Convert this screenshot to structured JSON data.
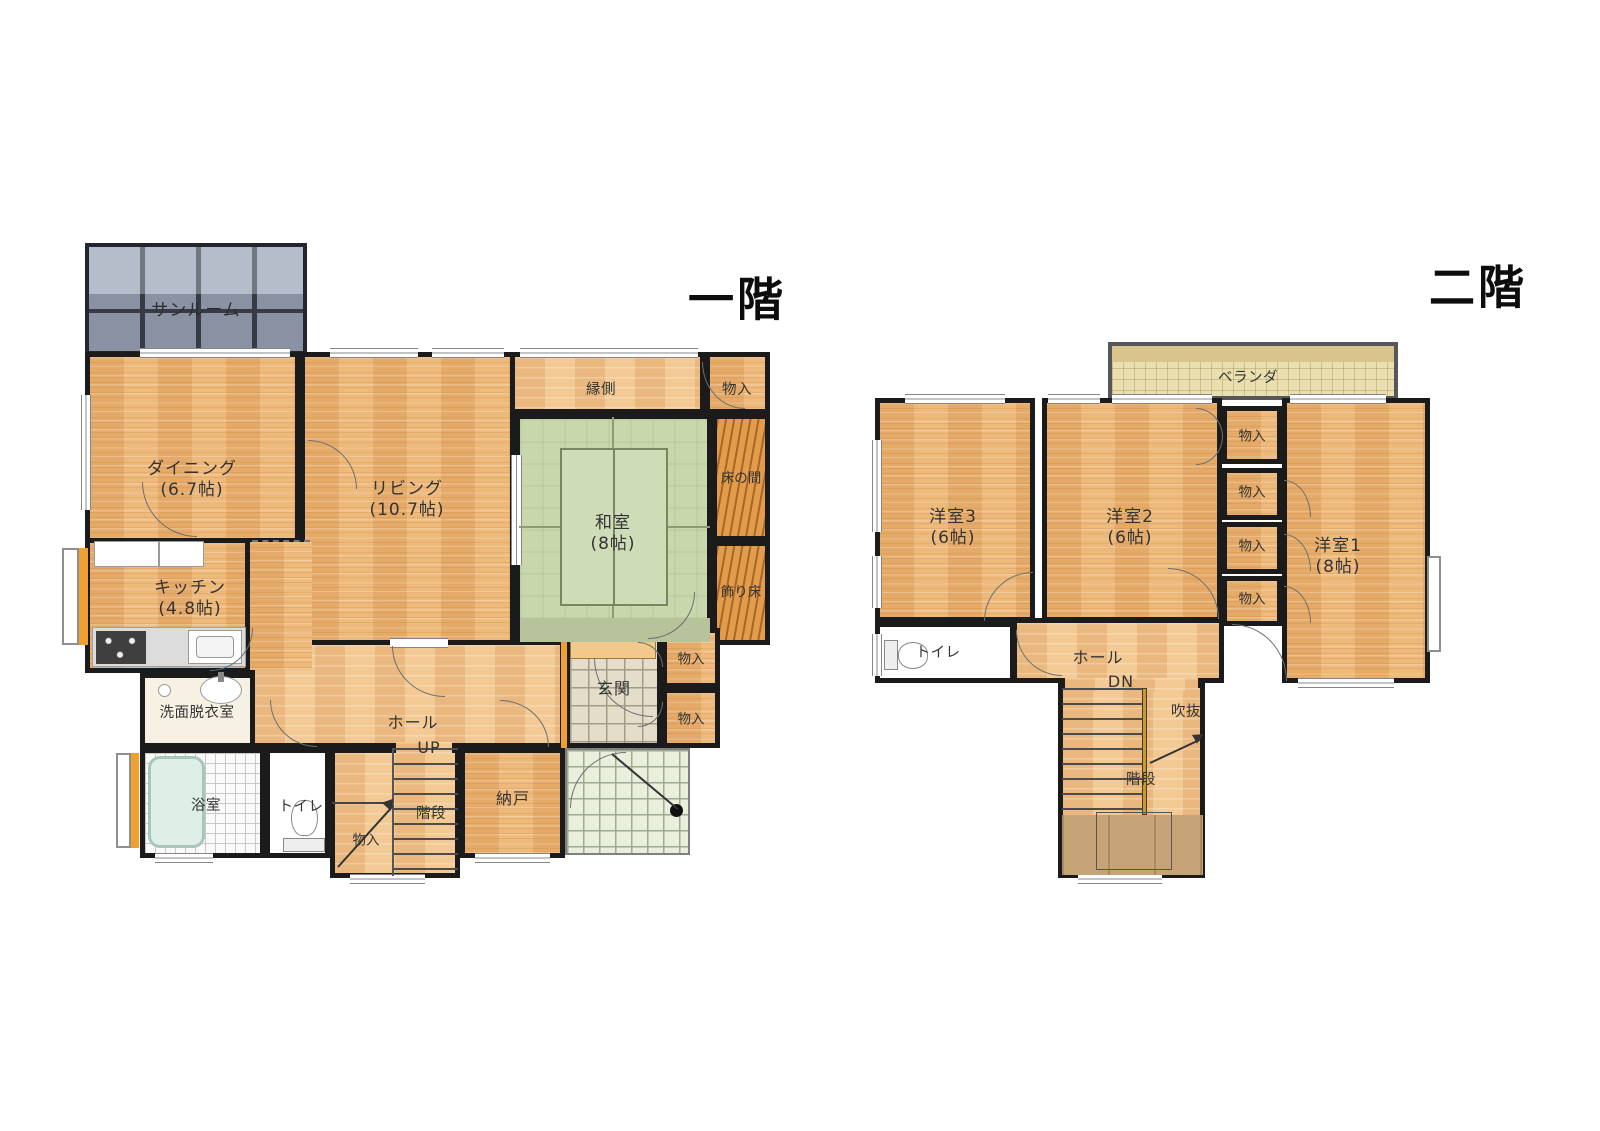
{
  "document": {
    "type": "floor-plan",
    "building": "2-story house"
  },
  "titles": {
    "first_floor": "一階",
    "second_floor": "二階"
  },
  "floor1": {
    "rooms": {
      "sunroom": "サンルーム",
      "dining": "ダイニング\n(6.7帖)",
      "living": "リビング\n(10.7帖)",
      "engawa": "縁側",
      "washitsu": "和室\n(8帖)",
      "tokonoma": "床の間",
      "kazaridoko": "飾り床",
      "kitchen": "キッチン\n(4.8帖)",
      "senmen": "洗面脱衣室",
      "bath": "浴室",
      "toilet": "トイレ",
      "hall": "ホール",
      "hall_dir": "UP",
      "stairs": "階段",
      "nando": "納戸",
      "genkan": "玄関",
      "closet": "物入"
    }
  },
  "floor2": {
    "rooms": {
      "veranda": "ベランダ",
      "yoshitsu1": "洋室1\n(8帖)",
      "yoshitsu2": "洋室2\n(6帖)",
      "yoshitsu3": "洋室3\n(6帖)",
      "closet": "物入",
      "toilet": "トイレ",
      "hall": "ホール",
      "hall_dir": "DN",
      "fukinuke": "吹抜",
      "stairs": "階段"
    }
  },
  "colors": {
    "wall": "#1b1b1b",
    "wood_floor": "#eaaf6e",
    "hall_floor": "#f0c189",
    "tatami_green": "#c9d7ad",
    "sunroom_glass": "#99a3b5",
    "tokonoma_wood": "#d8913f",
    "accent_orange": "#f0a030",
    "entry_tile": "#e3ddca",
    "porch_tile": "#e9efdc",
    "bath_tile": "#fafafa",
    "balcony_tile": "#eadfae"
  }
}
